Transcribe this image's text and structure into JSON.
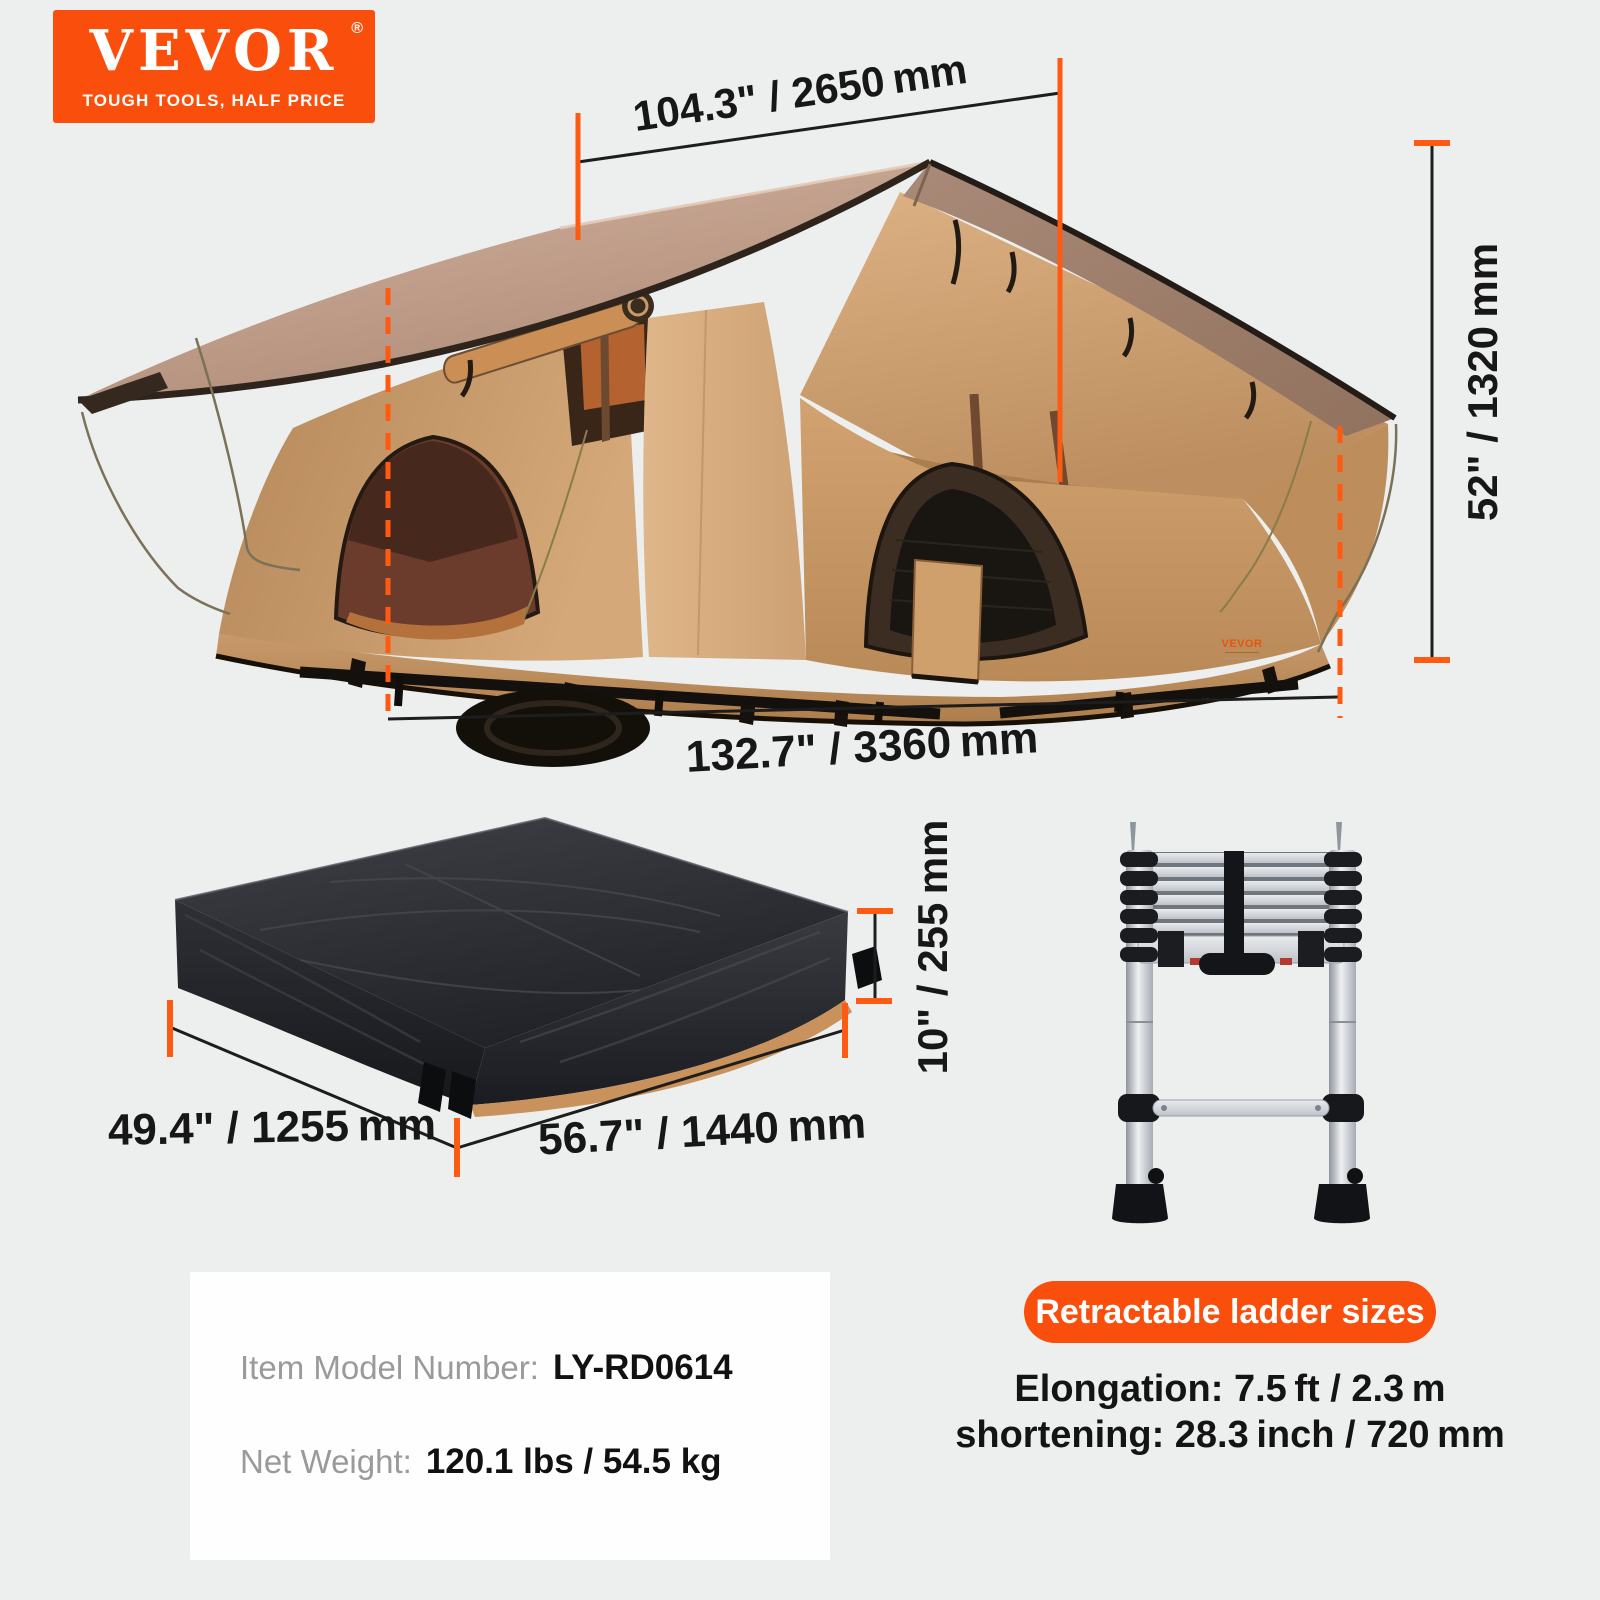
{
  "page": {
    "background": "#edeeee"
  },
  "colors": {
    "brand_orange": "#fa4e0c",
    "dimension_orange": "#ff5a12",
    "dimension_line": "#1d1d1d",
    "text_dark": "#171717",
    "label_gray": "#9a9a9a",
    "card_background": "#fefefe",
    "tent_canvas_tan": "#c99c6c",
    "roof_taupe": "#b5937f",
    "package_black": "#1d1e23",
    "ladder_silver": "#c7cbd0"
  },
  "logo": {
    "brand": "VEVOR",
    "registered": "®",
    "tagline": "TOUGH TOOLS, HALF PRICE"
  },
  "tent": {
    "dim_top": "104.3\" / 2650 mm",
    "dim_height": "52\" / 1320 mm",
    "dim_length": "132.7\" / 3360 mm",
    "brand_tag": "VEVOR"
  },
  "package": {
    "dim_width": "49.4\" / 1255 mm",
    "dim_length": "56.7\" / 1440 mm",
    "dim_height": "10\" / 255 mm"
  },
  "ladder": {
    "badge": "Retractable ladder sizes",
    "elongation": "Elongation: 7.5 ft / 2.3 m",
    "shortening": "shortening: 28.3 inch / 720 mm"
  },
  "card": {
    "model_label": "Item Model Number:",
    "model_value": "LY-RD0614",
    "weight_label": "Net Weight:",
    "weight_value": "120.1 lbs / 54.5 kg"
  }
}
